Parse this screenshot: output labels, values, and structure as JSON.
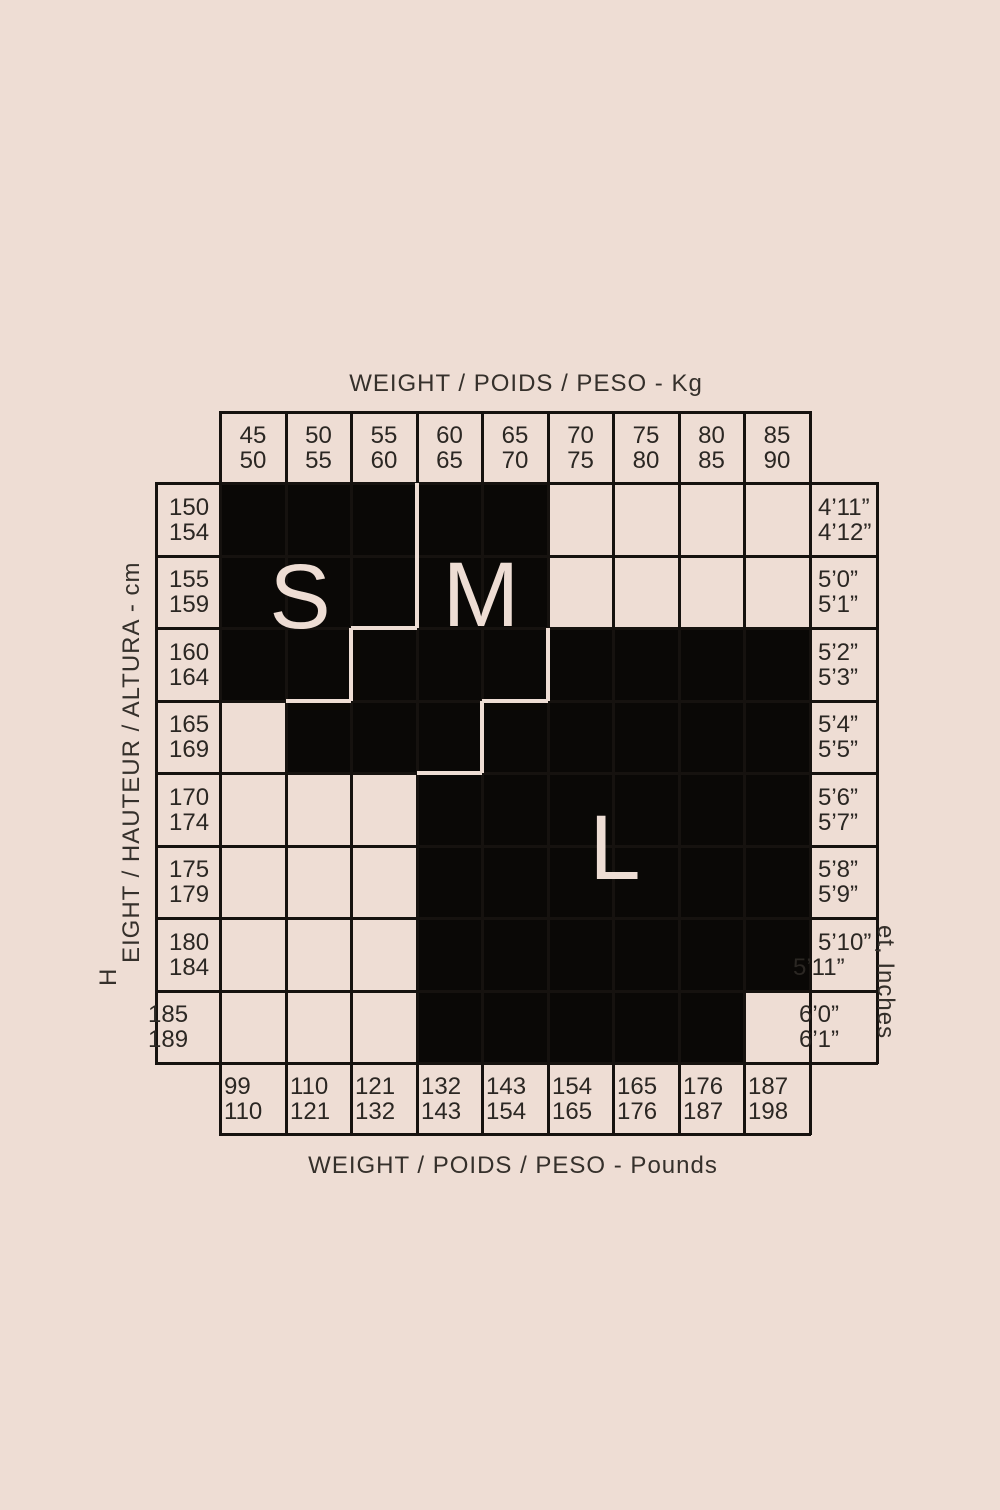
{
  "titles": {
    "top": "WEIGHT / POIDS / PESO - Kg",
    "bottom": "WEIGHT / POIDS / PESO - Pounds"
  },
  "axes": {
    "left_prefix": "H",
    "left": "EIGHT / HAUTEUR / ALTURA - cm",
    "right": "et, Inches"
  },
  "weight_kg": [
    "45\n50",
    "50\n55",
    "55\n60",
    "60\n65",
    "65\n70",
    "70\n75",
    "75\n80",
    "80\n85",
    "85\n90"
  ],
  "weight_lb": [
    "99\n110",
    "110\n121",
    "121\n132",
    "132\n143",
    "143\n154",
    "154\n165",
    "165\n176",
    "176\n187",
    "187\n198"
  ],
  "height_cm": [
    "150\n154",
    "155\n159",
    "160\n164",
    "165\n169",
    "170\n174",
    "175\n179",
    "180\n184",
    "185\n189"
  ],
  "height_ft": [
    [
      "4’11”",
      "4’12”"
    ],
    [
      "5’0”",
      "5’1”"
    ],
    [
      "5’2”",
      "5’3”"
    ],
    [
      "5’4”",
      "5’5”"
    ],
    [
      "5’6”",
      "5’7”"
    ],
    [
      "5’8”",
      "5’9”"
    ],
    [
      "5’10”",
      "5’11”"
    ],
    [
      "6’0”",
      "6’1”"
    ]
  ],
  "sizes": {
    "small": "S",
    "medium": "M",
    "large": "L"
  },
  "colors": {
    "background": "#eeddd4",
    "block": "#0a0806",
    "grid_line": "#16120f",
    "text": "#2b2723"
  },
  "chart_data": {
    "type": "table",
    "title": "Garment size chart (S / M / L) by weight and height",
    "x_axis_top": {
      "label": "WEIGHT / POIDS / PESO - Kg",
      "columns": [
        "45-50",
        "50-55",
        "55-60",
        "60-65",
        "65-70",
        "70-75",
        "75-80",
        "80-85",
        "85-90"
      ]
    },
    "x_axis_bottom": {
      "label": "WEIGHT / POIDS / PESO - Pounds",
      "columns": [
        "99-110",
        "110-121",
        "121-132",
        "132-143",
        "143-154",
        "154-165",
        "165-176",
        "176-187",
        "187-198"
      ]
    },
    "y_axis_left": {
      "label": "HEIGHT / HAUTEUR / ALTURA - cm",
      "rows": [
        "150-154",
        "155-159",
        "160-164",
        "165-169",
        "170-174",
        "175-179",
        "180-184",
        "185-189"
      ]
    },
    "y_axis_right": {
      "label": "Feet, Inches (rendered as: et, Inches)",
      "rows": [
        "4'11\"-4'12\"",
        "5'0\"-5'1\"",
        "5'2\"-5'3\"",
        "5'4\"-5'5\"",
        "5'6\"-5'7\"",
        "5'8\"-5'9\"",
        "5'10\"-5'11\"",
        "6'0\"-6'1\""
      ]
    },
    "cells": [
      [
        "S",
        "S",
        "S",
        "M",
        "M",
        "",
        "",
        "",
        ""
      ],
      [
        "S",
        "S",
        "S",
        "M",
        "M",
        "",
        "",
        "",
        ""
      ],
      [
        "S",
        "S",
        "M",
        "M",
        "M",
        "L",
        "L",
        "L",
        "L"
      ],
      [
        "",
        "M",
        "M",
        "M",
        "L",
        "L",
        "L",
        "L",
        "L"
      ],
      [
        "",
        "",
        "",
        "L",
        "L",
        "L",
        "L",
        "L",
        "L"
      ],
      [
        "",
        "",
        "",
        "L",
        "L",
        "L",
        "L",
        "L",
        "L"
      ],
      [
        "",
        "",
        "",
        "L",
        "L",
        "L",
        "L",
        "L",
        "L"
      ],
      [
        "",
        "",
        "",
        "L",
        "L",
        "L",
        "L",
        "L",
        ""
      ]
    ],
    "legend_position": "in-plot letters",
    "grid": true
  }
}
